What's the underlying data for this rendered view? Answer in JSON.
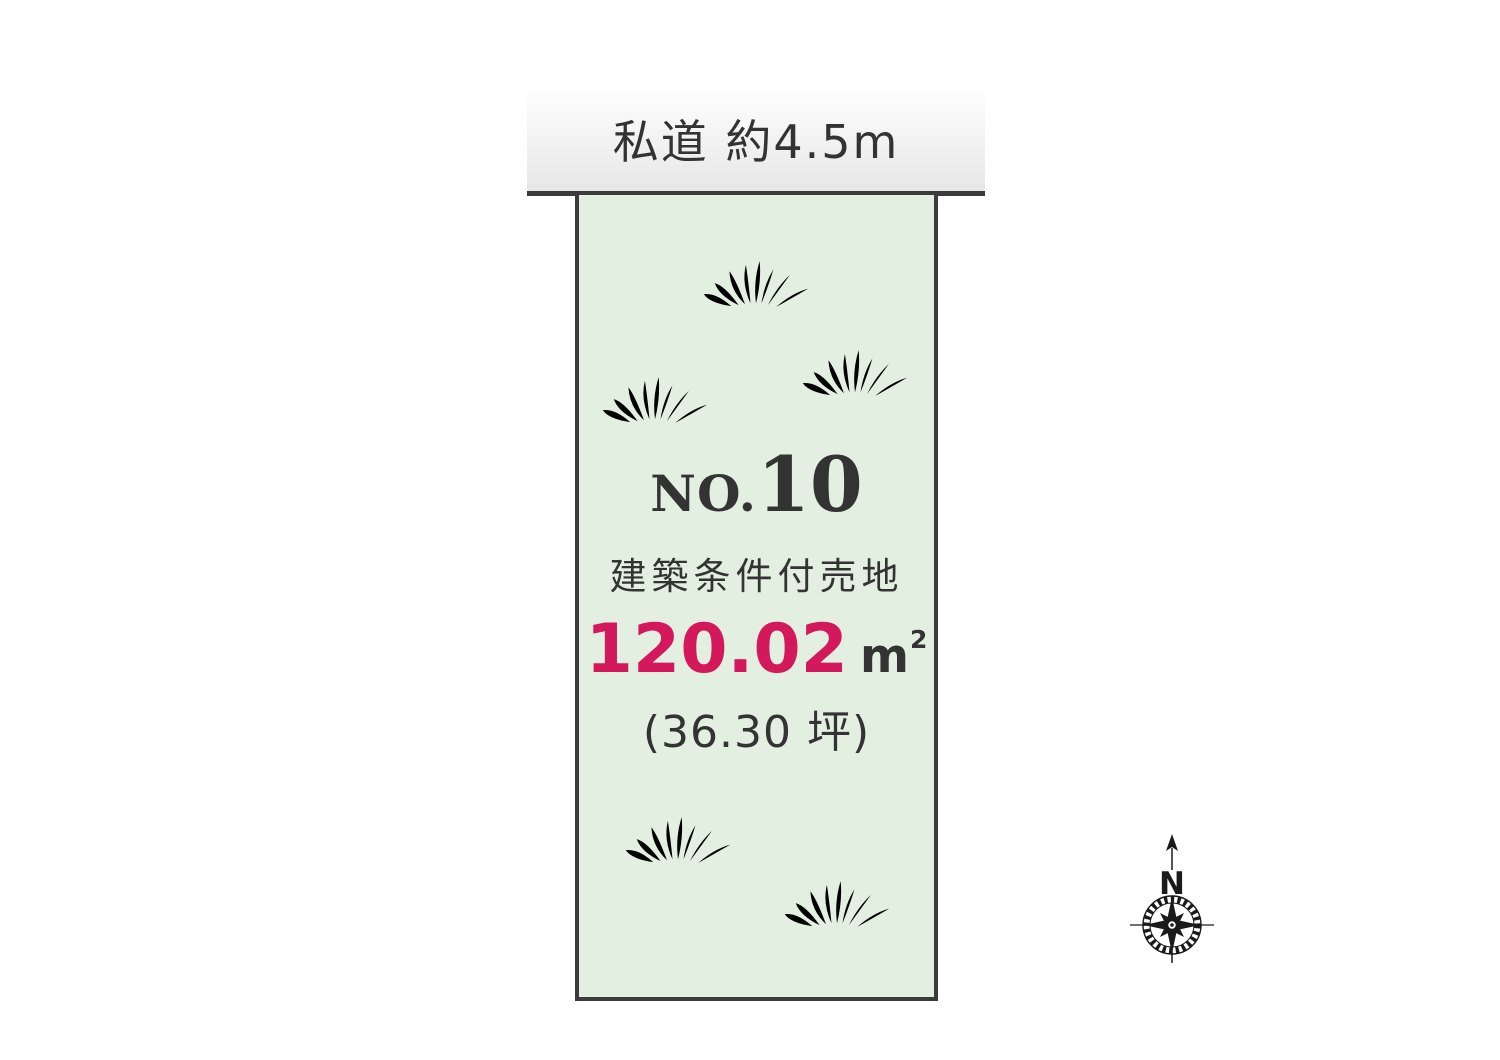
{
  "colors": {
    "accent": "#d4185c",
    "plot-fill": "#e3efe1",
    "grass": "#a3d29e",
    "border-dark": "#3b3b3b",
    "text-dark": "#333333",
    "road-top": "#ffffff",
    "road-bottom": "#e7e7e7",
    "ink": "#1a1a1a"
  },
  "road": {
    "label": "私道 約4.5m"
  },
  "plot": {
    "number_prefix": "NO.",
    "number": "10",
    "category": "建築条件付売地",
    "area_value": "120.02",
    "area_unit_base": "m",
    "area_unit_exp": "2",
    "area_tsubo": "(36.30 坪)"
  },
  "compass": {
    "north_label": "N"
  }
}
